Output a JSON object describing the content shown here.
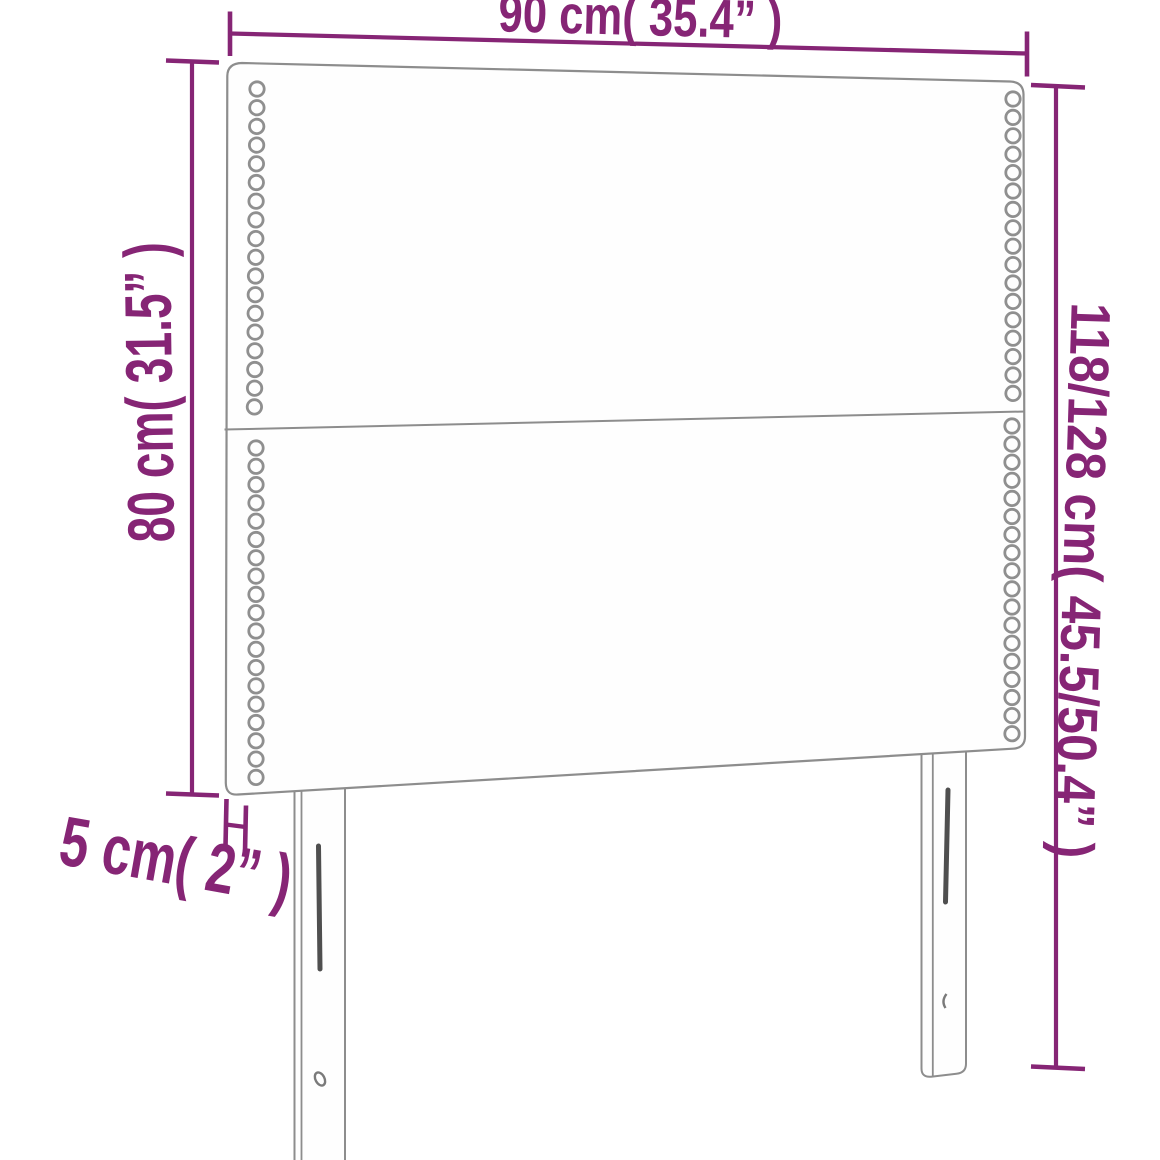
{
  "diagram": {
    "name": "headboard-dimension-diagram",
    "product": "Upholstered headboard panels with legs",
    "labels": {
      "width": "90 cm( 35.4” )",
      "panel_height": "80 cm( 31.5” )",
      "total_height": "118/128 cm( 45.5/50.4” )",
      "depth": "5 cm( 2” )"
    },
    "studs": {
      "columns": [
        {
          "panel": "upper",
          "side": "left",
          "count": 18
        },
        {
          "panel": "upper",
          "side": "right",
          "count": 17
        },
        {
          "panel": "lower",
          "side": "left",
          "count": 19
        },
        {
          "panel": "lower",
          "side": "right",
          "count": 18
        }
      ]
    },
    "palette": {
      "dimension_color": "#862575",
      "outline_color": "#8d8d8d",
      "slot_color": "#4f4f4f",
      "background": "#ffffff"
    }
  }
}
